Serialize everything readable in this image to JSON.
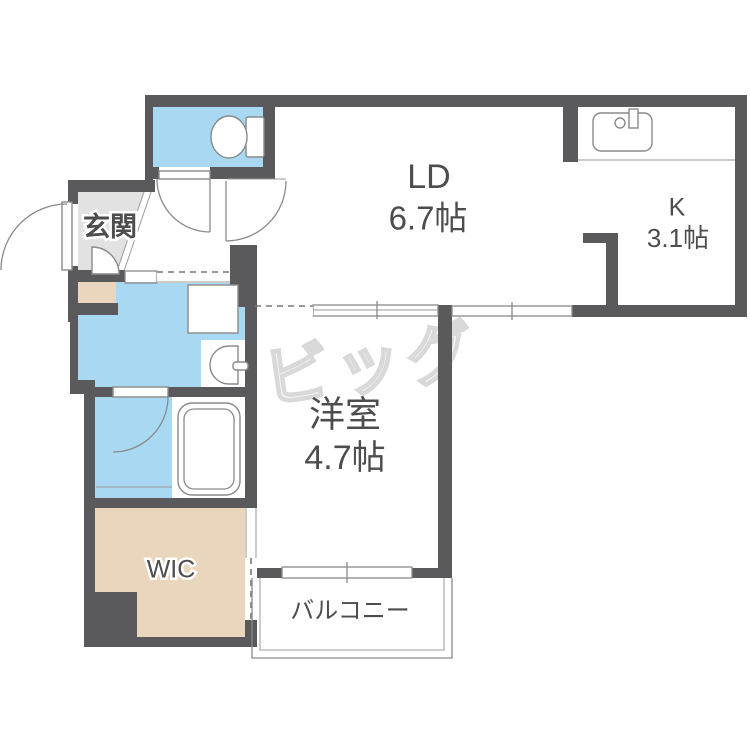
{
  "document": {
    "type": "apartment-floor-plan"
  },
  "colors": {
    "wall": "#5a5a5c",
    "water": "#a9d9f2",
    "entrance": "#e2e2e2",
    "storage": "#e9d6bc",
    "line": "#8a8a8a",
    "text": "#4d4d4d",
    "watermark": "#d9d9d9",
    "floor": "#ffffff"
  },
  "rooms": {
    "living_dining": {
      "label": "LD",
      "area": "6.7帖"
    },
    "kitchen": {
      "label": "K",
      "area": "3.1帖"
    },
    "western_room": {
      "label": "洋室",
      "area": "4.7帖"
    },
    "entrance": {
      "label": "玄関"
    },
    "walk_in_closet": {
      "label": "WIC"
    },
    "balcony": {
      "label": "バルコニー"
    }
  },
  "watermark": {
    "text": "ビッグ"
  }
}
